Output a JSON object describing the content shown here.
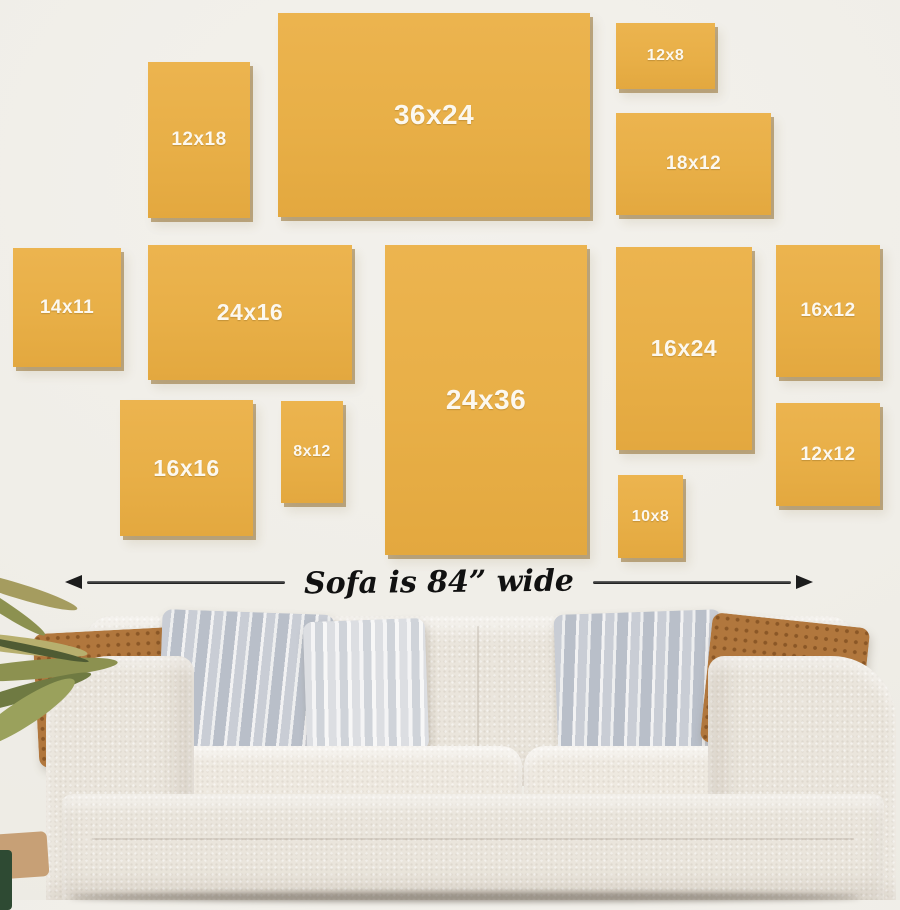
{
  "scene": {
    "description": "Wall art size comparison guide above a sofa"
  },
  "frames": [
    {
      "label": "12x18"
    },
    {
      "label": "36x24"
    },
    {
      "label": "12x8"
    },
    {
      "label": "18x12"
    },
    {
      "label": "14x11"
    },
    {
      "label": "24x16"
    },
    {
      "label": "24x36"
    },
    {
      "label": "16x24"
    },
    {
      "label": "16x12"
    },
    {
      "label": "16x16"
    },
    {
      "label": "8x12"
    },
    {
      "label": "10x8"
    },
    {
      "label": "12x12"
    }
  ],
  "measure": {
    "caption": "Sofa is 84” wide"
  },
  "colors": {
    "wall": "#f0eee8",
    "frame_gold": "#e8af47",
    "frame_shadow": "#926e2e",
    "frame_label_text": "#fcf8ef",
    "arrow_black": "#1c1c1c",
    "sofa_cream": "#eae5dc",
    "pillow_rust": "#b1773d",
    "pillow_gray_stripe": "#c9cdd5",
    "plant_olive": "#8c9150",
    "pot_dark_green": "#2e4a33"
  }
}
